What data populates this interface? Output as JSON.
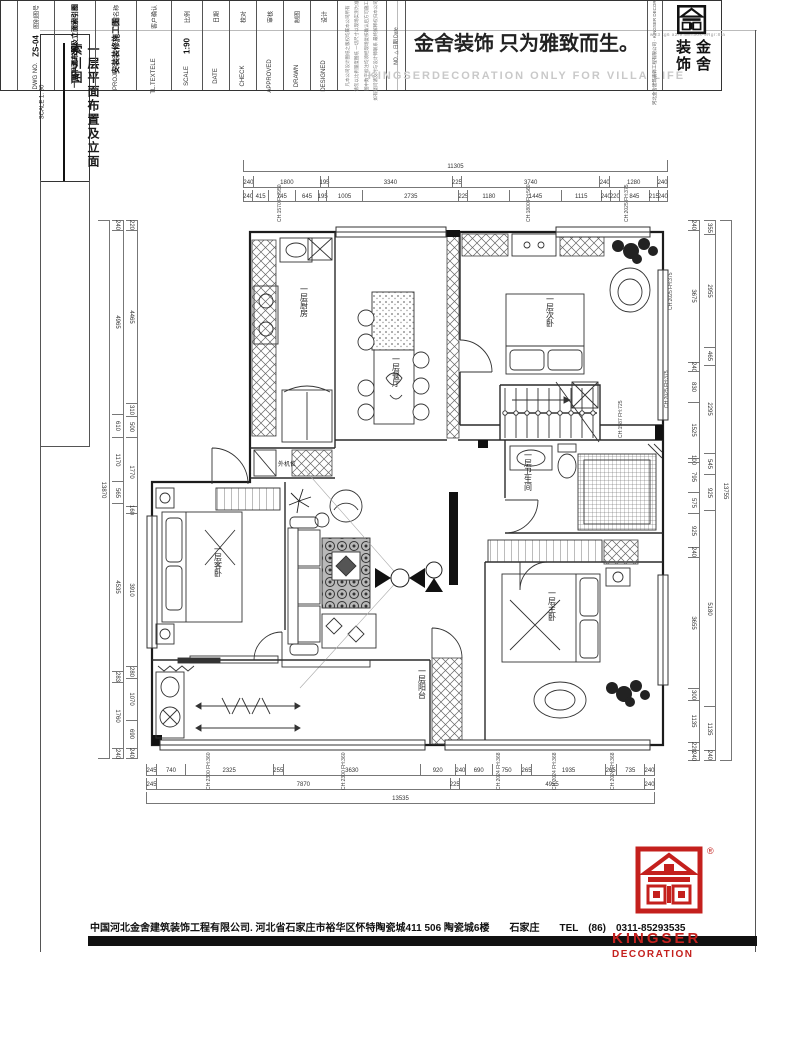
{
  "sheet": {
    "side_title": "一层平面布置及立面索引图",
    "side_scale": "SCALE 1: 90",
    "plot_stamp": "w:r3 tg6 a2/9:58=30s-9Rgr:8ta",
    "company_line": "中国河北金舍建筑装饰工程有限公司. 河北省石家庄市裕华区怀特陶瓷城411 506 陶瓷城6楼　　石家庄　　TEL　(86)　0311-85293535"
  },
  "logo": {
    "brand_top": "KINGSER",
    "brand_bottom": "DECORATION",
    "reg_mark": "®"
  },
  "plan": {
    "rooms": {
      "kitchen": "一层厨房",
      "dining": "一层餐厅",
      "bedroom2": "一层次卧",
      "bath": "一层卫生间",
      "master": "一层主卧",
      "guest": "一层客卧",
      "balcony": "一层阳台",
      "ac_unit": "外机位"
    },
    "annotations": [
      "CH:1570 FH:950",
      "CH:1800 FH:560",
      "CH:2025 FH:375",
      "CH:2025 FH:375",
      "CH:2025 FH:375",
      "CH:1587 FH:725",
      "CH:2300 FH:360",
      "CH:2300 FH:360",
      "CH:2024 FH:368",
      "CH:2024 FH:368",
      "CH:2024 FH:368"
    ]
  },
  "dims": {
    "top1": [
      11305
    ],
    "top2": [
      240,
      1800,
      195,
      3340,
      225,
      3740,
      240,
      1280,
      240
    ],
    "top3": [
      240,
      415,
      745,
      645,
      195,
      1005,
      2735,
      225,
      1180,
      1445,
      1115,
      240,
      220,
      845,
      215,
      240
    ],
    "bottom1": [
      245,
      740,
      2325,
      255,
      3630,
      920,
      240,
      690,
      750,
      265,
      1935,
      265,
      735,
      240
    ],
    "bottom2": [
      245,
      7870,
      225,
      4955,
      240
    ],
    "bottom3": [
      13535
    ],
    "left1": [
      13870
    ],
    "left2": [
      240,
      4965,
      610,
      1170,
      565,
      4535,
      283,
      1760,
      240
    ],
    "left3": [
      220,
      4465,
      310,
      500,
      1770,
      160,
      3910,
      280,
      1070,
      690,
      240
    ],
    "right1": [
      240,
      3675,
      240,
      830,
      1525,
      100,
      795,
      575,
      925,
      240,
      3655,
      300,
      1135,
      220,
      240
    ],
    "right2": [
      355,
      2955,
      465,
      2295,
      545,
      925,
      5180,
      1135,
      240
    ],
    "right3": [
      13755
    ]
  },
  "titleblock": {
    "cols": [
      {
        "cn": "图别图号",
        "en": "DWG NO.",
        "value": "ZS-04"
      },
      {
        "cn": "图纸名称",
        "en": "TITLE",
        "value": "一层平面布置及立面索引图"
      },
      {
        "cn": "工程名称",
        "en": "PROJECT",
        "value": "安装装修施工图"
      },
      {
        "cn": "客户确认",
        "en": "TL.TEXTELE",
        "value": ""
      },
      {
        "cn": "比例",
        "en": "SCALE",
        "value": "1:90"
      },
      {
        "cn": "日期",
        "en": "DATE",
        "value": ""
      },
      {
        "cn": "校对",
        "en": "CHECK",
        "value": ""
      },
      {
        "cn": "审核",
        "en": "APPROVED",
        "value": ""
      },
      {
        "cn": "制图",
        "en": "DRAWN",
        "value": ""
      },
      {
        "cn": "设计",
        "en": "DESIGNED",
        "value": ""
      }
    ],
    "notes": [
      "凡本公司设计图纸之版权均属本公司所有",
      "请勿以比例量度图纸 一切尺寸以现场实测为准",
      "图中数字标注均须经现场复核确认后方可施工",
      "如有疑问请及时与设计师联系 最终解释权归本公司所有"
    ],
    "revision": "NO.  △  日期 Date",
    "slogan": "金舍装饰 只为雅致而生。",
    "watermark": "KINGSERDECORATION ONLY FOR VILLA LIFE",
    "company_col": "河北金舍建筑装饰工程有限公司 · KINGSER DECORATION",
    "stamp_right": "金舍",
    "stamp_left": "装饰"
  }
}
